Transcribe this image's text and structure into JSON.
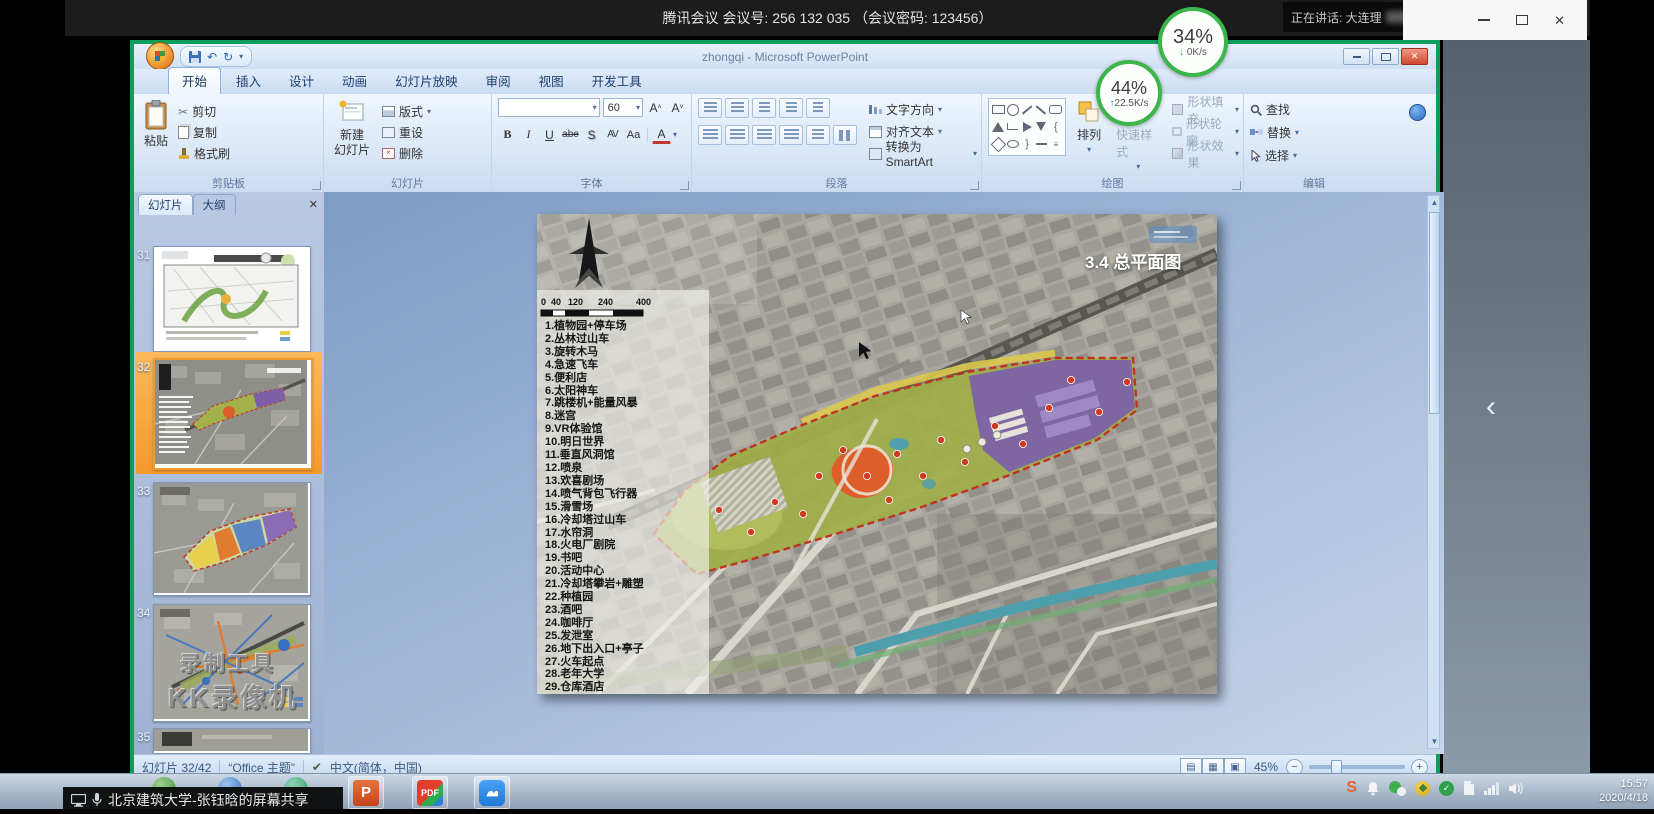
{
  "meeting": {
    "topbar_title": "腾讯会议 会议号: 256 132 035 （会议密码: 123456）",
    "speaking_label": "正在讲话: 大连理",
    "net_top": {
      "percent": "34%",
      "arrow": "↓",
      "speed": "0K/s"
    },
    "net_inner": {
      "percent": "44%",
      "arrow": "↑",
      "speed": "22.5K/s"
    },
    "prev_arrow": "‹"
  },
  "powerpoint": {
    "window_title": "zhongqi - Microsoft PowerPoint",
    "close_glyph": "✕",
    "tabs": [
      "开始",
      "插入",
      "设计",
      "动画",
      "幻灯片放映",
      "审阅",
      "视图",
      "开发工具"
    ],
    "ribbon": {
      "clipboard": {
        "group": "剪贴板",
        "paste": "粘贴",
        "cut": "剪切",
        "copy": "复制",
        "format_painter": "格式刷",
        "cut_glyph": "✂"
      },
      "slides": {
        "group": "幻灯片",
        "new_slide_line1": "新建",
        "new_slide_line2": "幻灯片",
        "layout": "版式",
        "reset": "重设",
        "delete": "删除"
      },
      "font": {
        "group": "字体",
        "size": "60",
        "bold": "B",
        "italic": "I",
        "underline": "U",
        "strike": "abe",
        "shadow": "S",
        "spacing": "AV",
        "case": "Aa",
        "color": "A",
        "grow": "A",
        "shrink": "A"
      },
      "paragraph": {
        "group": "段落",
        "text_direction": "文字方向",
        "align_text": "对齐文本",
        "smartart": "转换为 SmartArt"
      },
      "drawing": {
        "group": "绘图",
        "arrange": "排列",
        "quick_styles": "快速样式",
        "shape_fill": "形状填充",
        "shape_outline": "形状轮廓",
        "shape_effects": "形状效果"
      },
      "editing": {
        "group": "编辑",
        "find": "查找",
        "replace": "替换",
        "select": "选择"
      }
    },
    "quick_access": {
      "undo_glyph": "↶",
      "redo_glyph": "↻",
      "dropdown_glyph": "▾"
    },
    "left_panel": {
      "tab_slides": "幻灯片",
      "tab_outline": "大纲",
      "close_glyph": "✕",
      "numbers": [
        "31",
        "32",
        "33",
        "34",
        "35"
      ]
    },
    "watermark": {
      "line1": "录制工具",
      "line2": "KK录像机"
    },
    "status": {
      "slide_info": "幻灯片 32/42",
      "theme": "“Office 主题”",
      "check_glyph": "✔",
      "language": "中文(简体，中国)",
      "zoom": "45%",
      "zoom_out": "−",
      "zoom_in": "+"
    }
  },
  "slide": {
    "title": "3.4 总平面图",
    "scale_ticks": [
      "0",
      "40",
      "120",
      "240",
      "400"
    ],
    "legend": [
      "1.植物园+停车场",
      "2.丛林过山车",
      "3.旋转木马",
      "4.急速飞车",
      "5.便利店",
      "6.太阳神车",
      "7.跳楼机+能量风暴",
      "8.迷宫",
      "9.VR体验馆",
      "10.明日世界",
      "11.垂直风洞馆",
      "12.喷泉",
      "13.欢喜剧场",
      "14.喷气背包飞行器",
      "15.滑雪场",
      "16.冷却塔过山车",
      "17.水帘洞",
      "18.火电厂剧院",
      "19.书吧",
      "20.活动中心",
      "21.冷却塔攀岩+雕塑",
      "22.种植园",
      "23.酒吧",
      "24.咖啡厅",
      "25.发泄室",
      "26.地下出入口+亭子",
      "27.火车起点",
      "28.老年大学",
      "29.仓库酒店"
    ]
  },
  "taskbar": {
    "share_label": "北京建筑大学-张钰晗的屏幕共享",
    "ppt_icon_letter": "P",
    "pdf_label": "PDF",
    "tray_s": "S",
    "time": "15:57",
    "date": "2020/4/18"
  }
}
